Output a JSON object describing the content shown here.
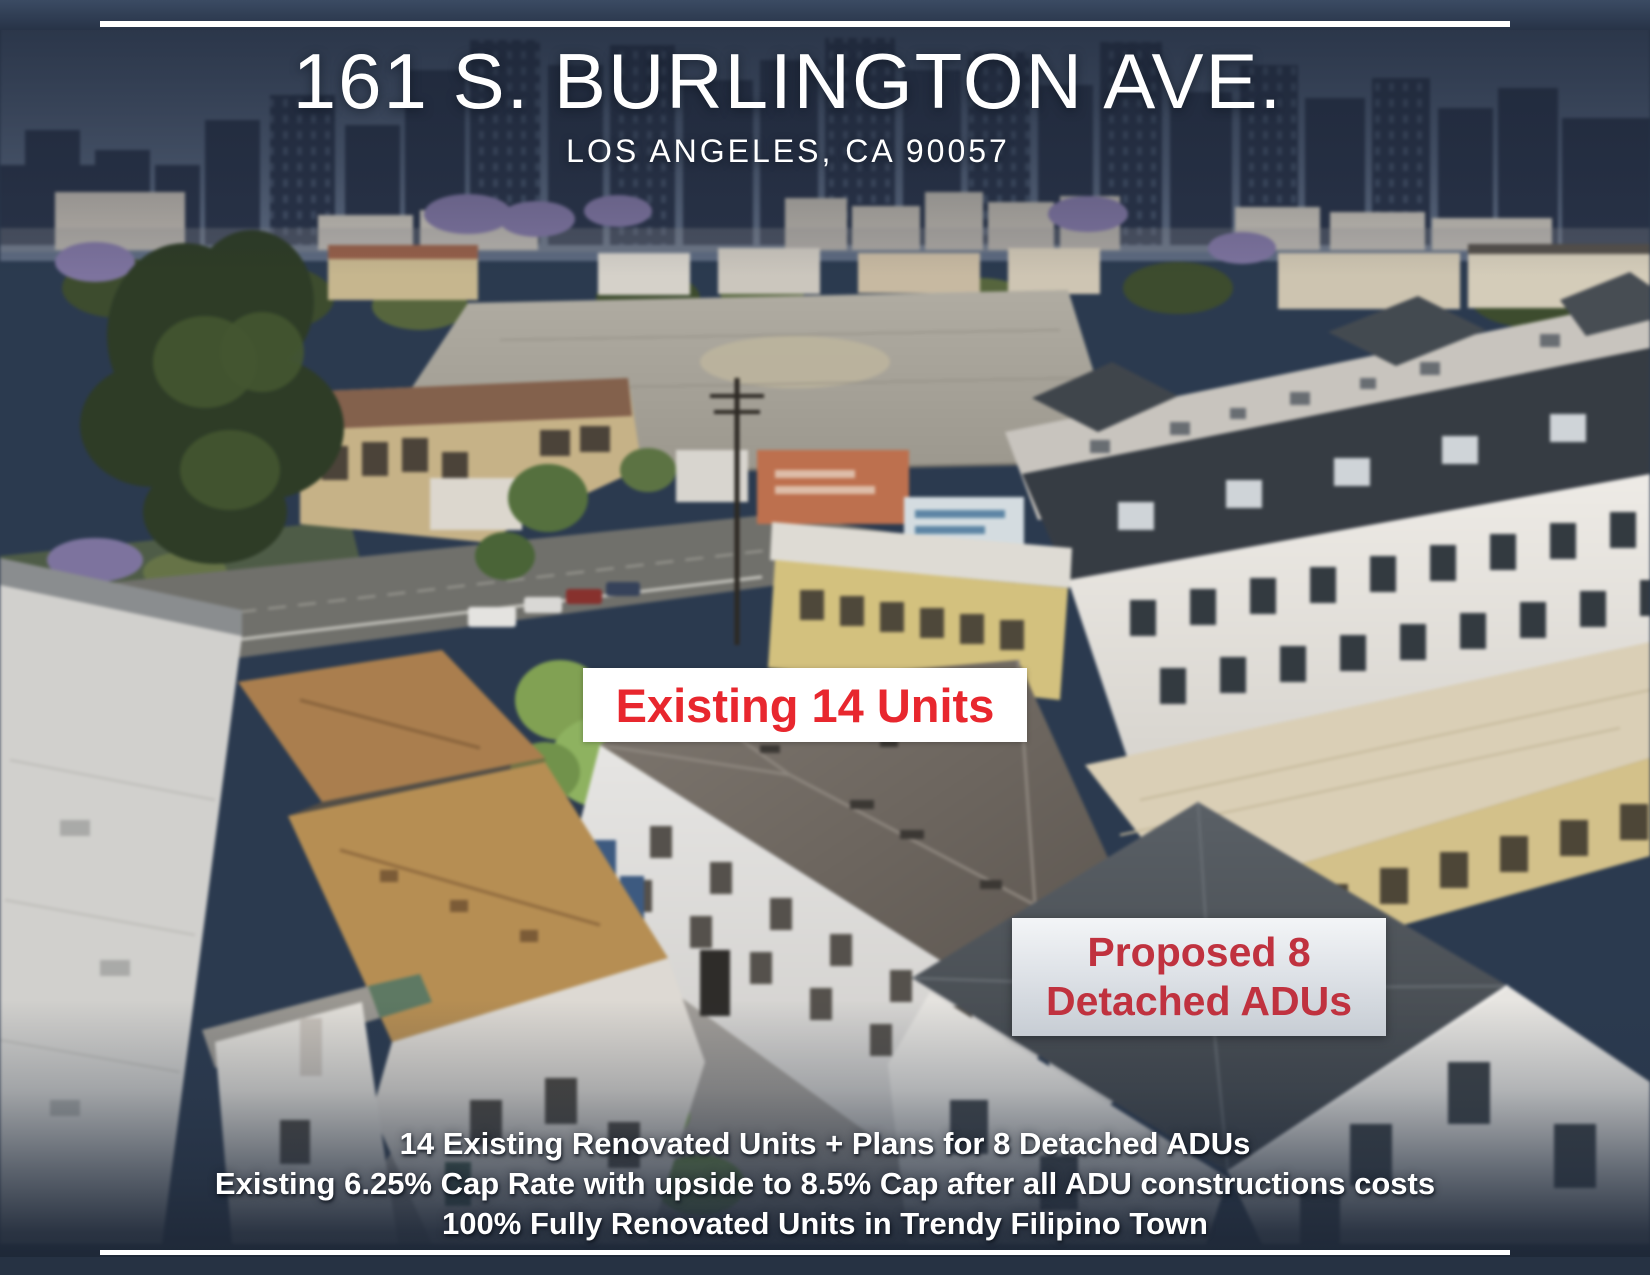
{
  "header": {
    "title": "161 S. BURLINGTON AVE.",
    "subtitle": "LOS ANGELES, CA 90057"
  },
  "annotations": {
    "existing_units": "Existing 14 Units",
    "proposed_adus_line1": "Proposed 8",
    "proposed_adus_line2": "Detached ADUs"
  },
  "footer": {
    "line1": "14 Existing Renovated Units + Plans for 8 Detached ADUs",
    "line2": "Existing 6.25% Cap Rate with upside to 8.5% Cap after all ADU constructions costs",
    "line3": "100% Fully Renovated Units in Trendy Filipino Town"
  },
  "colors": {
    "accent_red_bright": "#e8272e",
    "accent_red_dark": "#c0323f",
    "navy_bar": "#2b3a4f",
    "divider_white": "#ffffff"
  }
}
